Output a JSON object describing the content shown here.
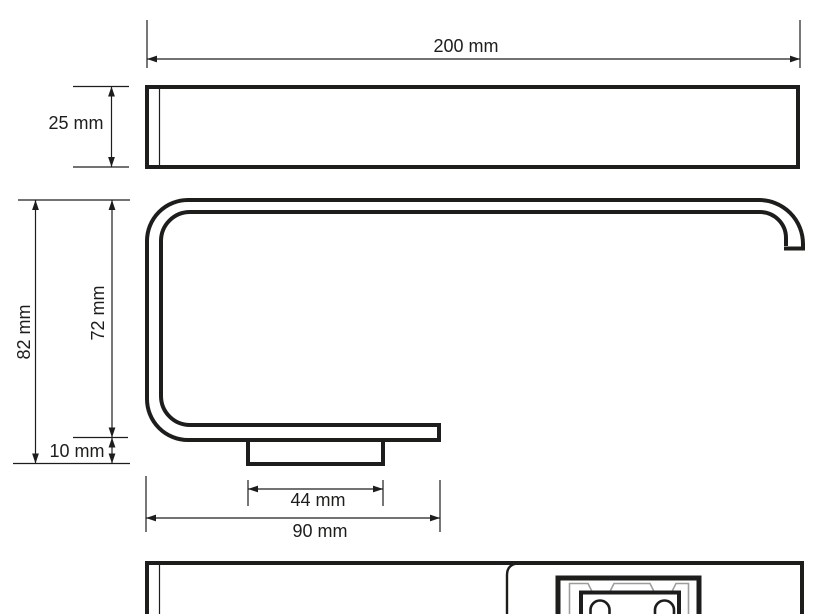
{
  "colors": {
    "background": "#ffffff",
    "line": "#1d1d1b",
    "clip_gray": "#9d9d9c"
  },
  "unit": "mm",
  "dimensions": {
    "length": {
      "value": 200,
      "label": "200 mm"
    },
    "front_height": {
      "value": 25,
      "label": "25 mm"
    },
    "total_depth": {
      "value": 82,
      "label": "82 mm"
    },
    "inner_depth": {
      "value": 72,
      "label": "72 mm"
    },
    "plate_depth": {
      "value": 10,
      "label": "10 mm"
    },
    "plate_width": {
      "value": 44,
      "label": "44 mm"
    },
    "mount_span": {
      "value": 90,
      "label": "90 mm"
    }
  }
}
